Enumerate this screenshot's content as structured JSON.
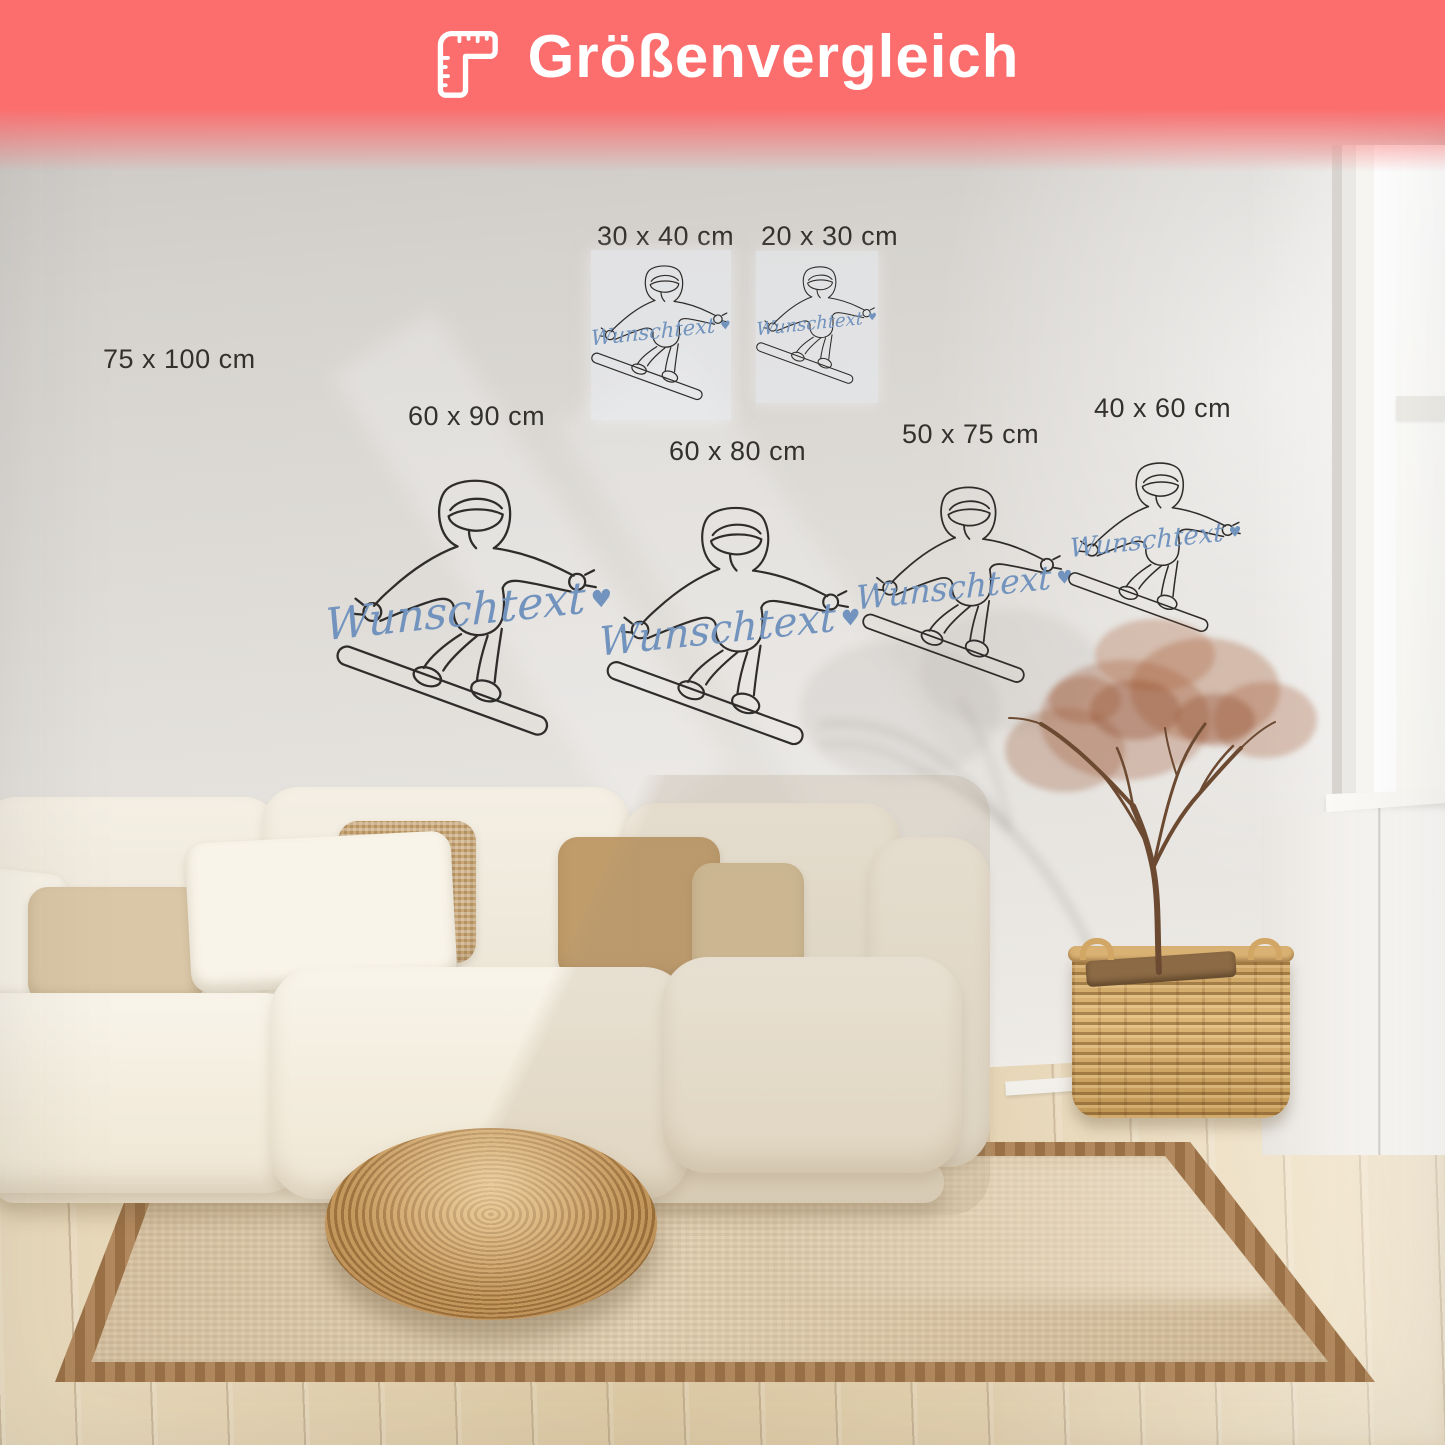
{
  "banner": {
    "title": "Größenvergleich",
    "icon": "ruler-icon",
    "background_color": "#FC6D6D",
    "text_color": "#FFFFFF"
  },
  "artwork": {
    "name": "snowboarder-line-art",
    "custom_text": "Wunschtext",
    "heart": "♥",
    "line_color": "#2F2D2B",
    "text_color": "#7193BD"
  },
  "sizes": [
    {
      "label": "75 x 100 cm"
    },
    {
      "label": "30 x 40 cm"
    },
    {
      "label": "20 x 30 cm"
    },
    {
      "label": "60 x 90 cm"
    },
    {
      "label": "60 x 80 cm"
    },
    {
      "label": "50 x 75 cm"
    },
    {
      "label": "40 x 60 cm"
    }
  ],
  "scene": {
    "wall_color": "#DCD9D5",
    "floor_color": "#E6D6B9",
    "rug_color": "#D9C6A8",
    "rug_border_color": "#AD8256",
    "sofa_color": "#F4EFE4",
    "pillow_colors": [
      "#F8F4EA",
      "#DAC7A7",
      "#CBA877",
      "#C09C6B"
    ],
    "pouf_color": "#C2945A",
    "basket_color": "#D8B06F",
    "dried_plant_color": "#A15A36",
    "label_text_color": "#33312E"
  }
}
